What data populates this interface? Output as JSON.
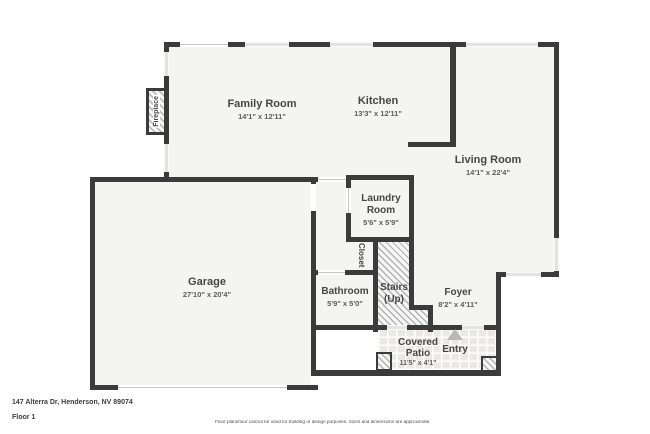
{
  "floorplan": {
    "address": "147 Alterra Dr, Henderson, NV 89074",
    "floor_label": "Floor 1",
    "disclaimer": "Floor plans/tour cannot be used for building or design purposes. Sizes and dimensions are approximate.",
    "rooms": {
      "family_room": {
        "name": "Family Room",
        "dims": "14'1\" x 12'11\""
      },
      "kitchen": {
        "name": "Kitchen",
        "dims": "13'3\" x 12'11\""
      },
      "living_room": {
        "name": "Living Room",
        "dims": "14'1\" x 22'4\""
      },
      "laundry_room": {
        "name_line1": "Laundry",
        "name_line2": "Room",
        "dims": "5'6\" x 5'9\""
      },
      "garage": {
        "name": "Garage",
        "dims": "27'10\" x 20'4\""
      },
      "bathroom": {
        "name": "Bathroom",
        "dims": "5'9\" x 5'0\""
      },
      "stairs": {
        "name_line1": "Stairs",
        "name_line2": "(Up)"
      },
      "foyer": {
        "name": "Foyer",
        "dims": "8'2\" x 4'11\""
      },
      "covered_patio": {
        "name_line1": "Covered",
        "name_line2": "Patio",
        "dims": "11'5\" x 4'1\""
      },
      "entry": {
        "name": "Entry"
      },
      "closet": {
        "name": "Closet"
      },
      "fireplace": {
        "name": "Fireplace"
      }
    },
    "colors": {
      "wall": "#3b3b3b",
      "floor": "#f4f4f3",
      "window": "#e3e3e2",
      "hatch_line": "#b3b3b3"
    }
  }
}
